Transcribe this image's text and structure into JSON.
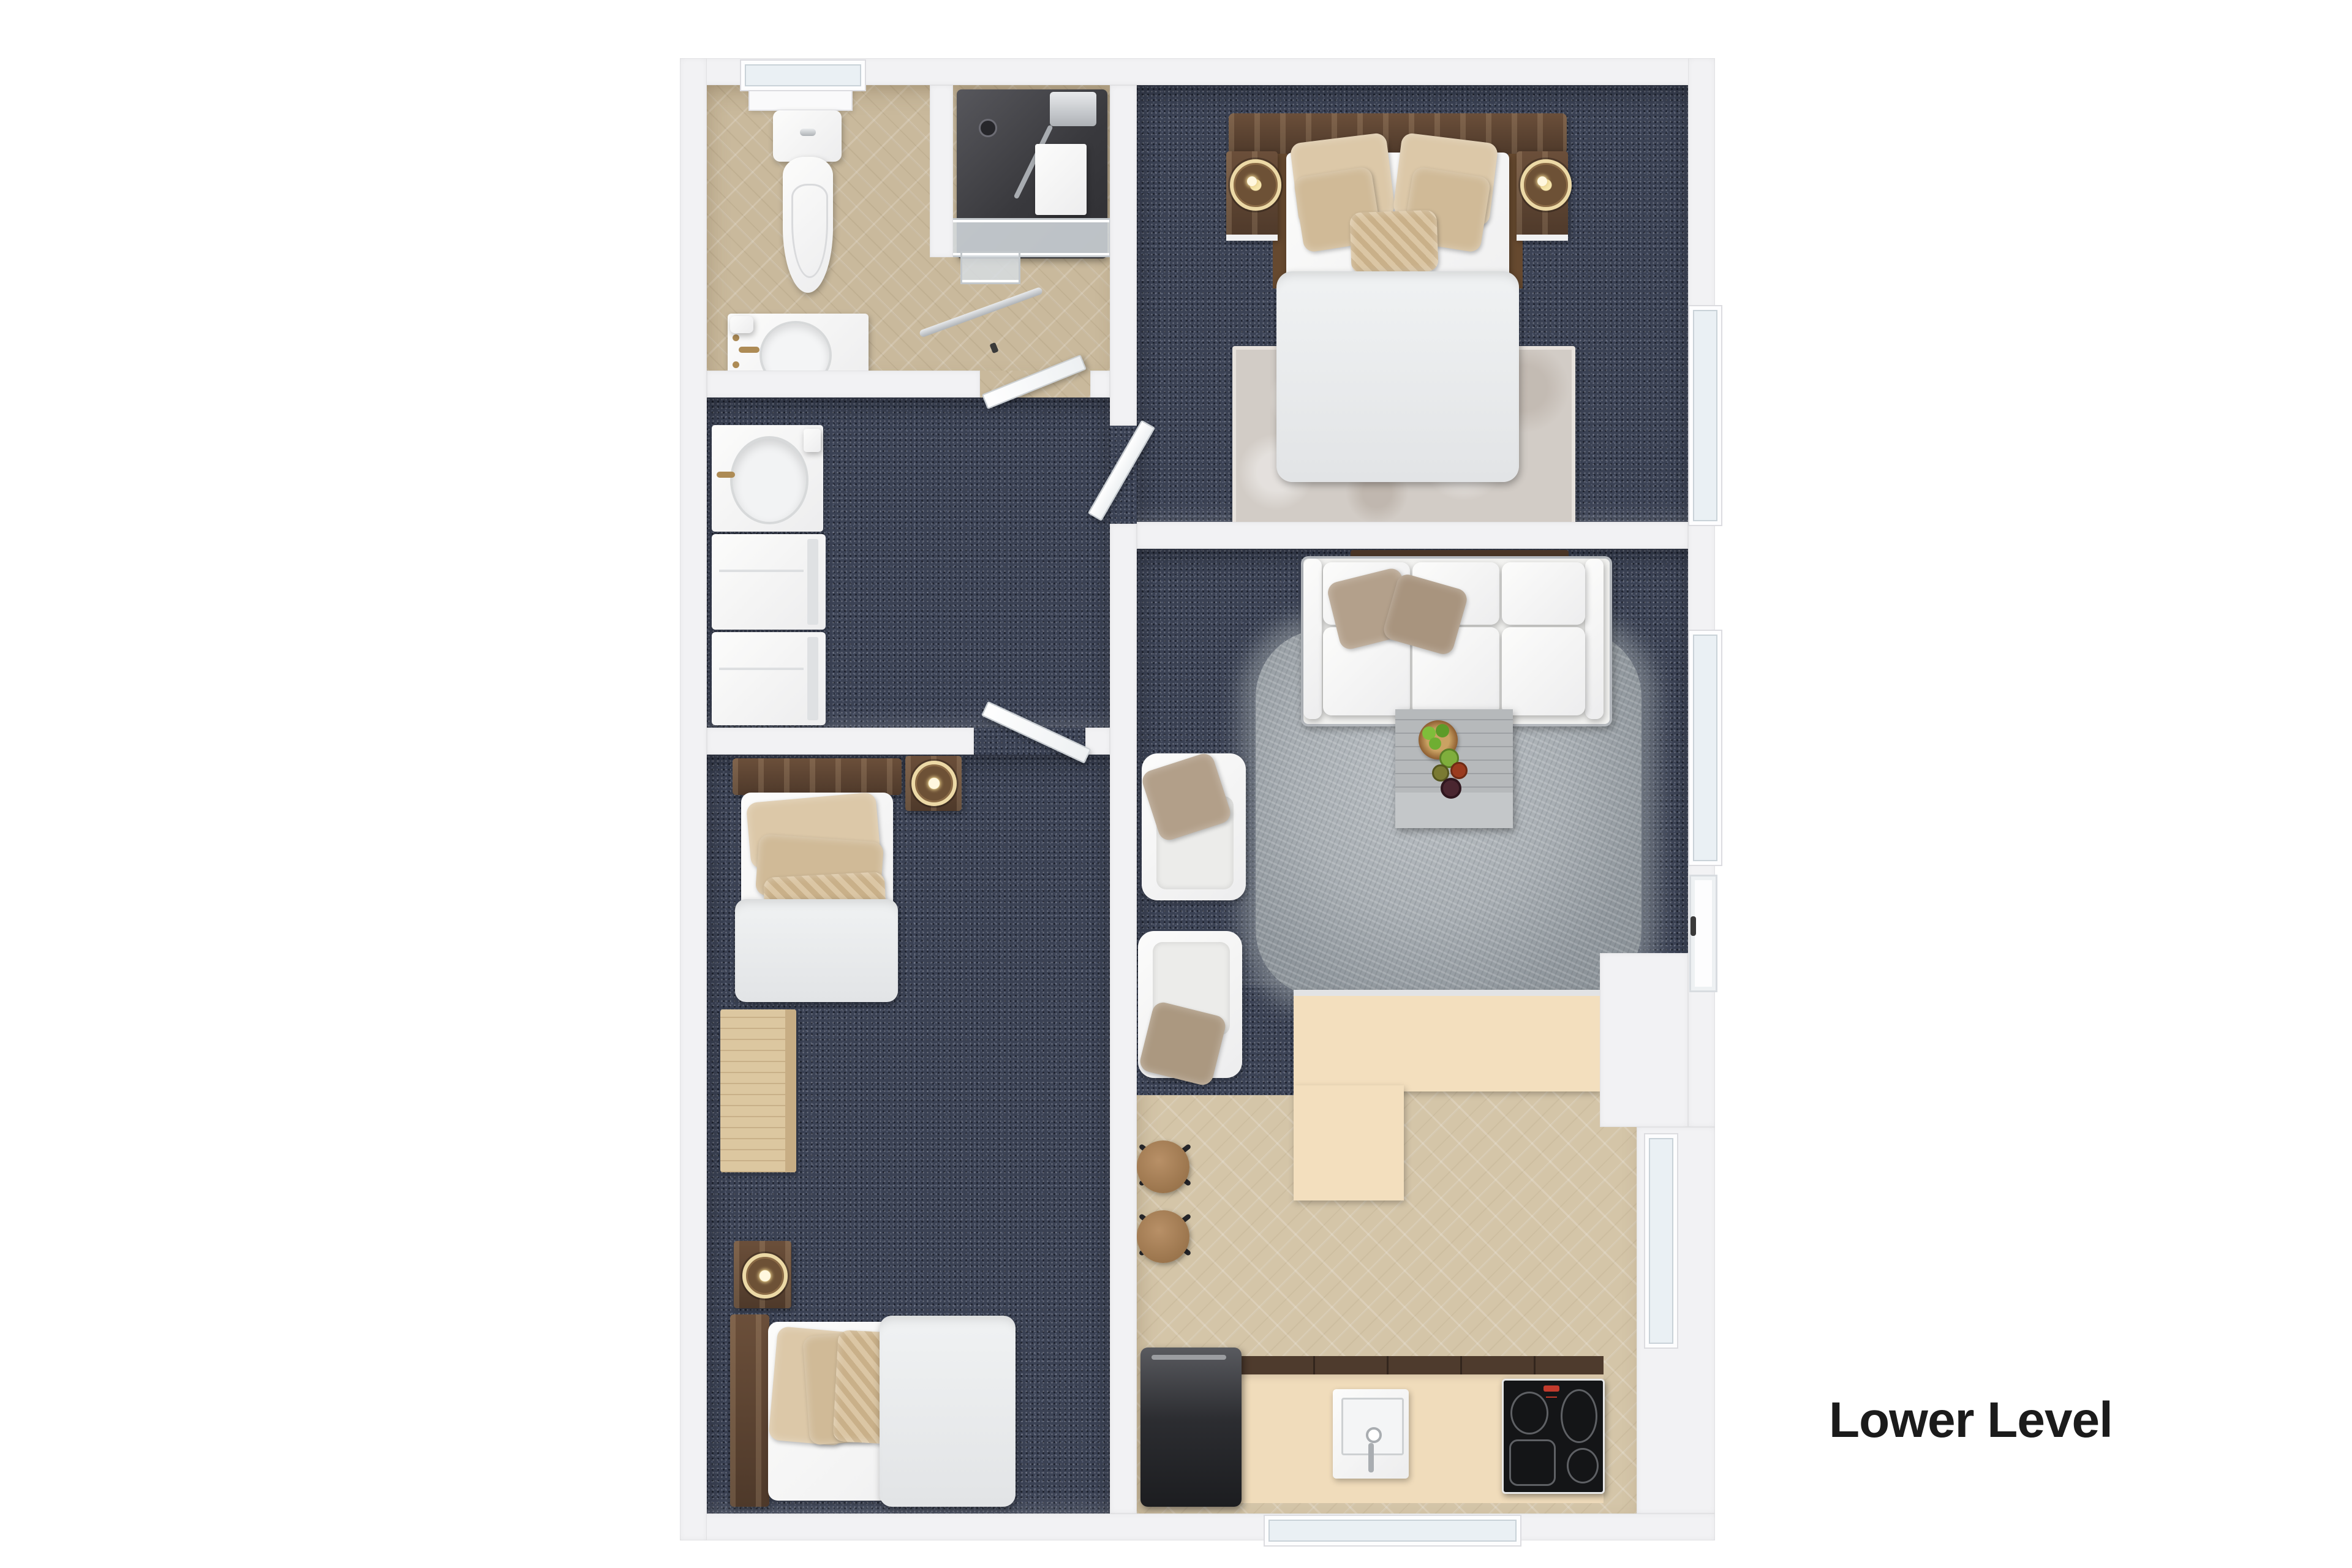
{
  "floor_plan": {
    "level_name": "Lower Level",
    "type": "3d-rendered top-down floor plan",
    "rooms": [
      {
        "name": "bathroom",
        "floor": "beige-tile",
        "furniture": [
          "toilet",
          "shower-enclosure",
          "vanity-sink",
          "window"
        ]
      },
      {
        "name": "laundry-room",
        "floor": "navy-carpet",
        "furniture": [
          "utility-sink",
          "washer",
          "dryer"
        ]
      },
      {
        "name": "bedroom",
        "floor": "navy-carpet",
        "furniture": [
          "twin-bed-1",
          "twin-bed-2",
          "nightstand-1",
          "nightstand-2",
          "table-lamp-1",
          "table-lamp-2",
          "dresser"
        ]
      },
      {
        "name": "primary-bedroom",
        "floor": "navy-carpet",
        "furniture": [
          "double-bed",
          "headboard",
          "nightstand-left",
          "nightstand-right",
          "table-lamp-left",
          "table-lamp-right",
          "area-rug",
          "window"
        ]
      },
      {
        "name": "living-room",
        "floor": "navy-carpet",
        "furniture": [
          "sofa",
          "console-shelf",
          "armchair-1",
          "armchair-2",
          "shag-rug",
          "coffee-table",
          "bowl-of-limes",
          "drink-cups",
          "window",
          "patio-door"
        ]
      },
      {
        "name": "kitchen",
        "floor": "beige-tile",
        "furniture": [
          "l-shaped-island-counter",
          "bar-stool-1",
          "bar-stool-2",
          "refrigerator",
          "kitchen-sink",
          "cooktop",
          "base-cabinets",
          "window-right",
          "window-bottom"
        ]
      }
    ],
    "doors": [
      "bathroom-door",
      "primary-bedroom-door",
      "bedroom-door"
    ],
    "colors": {
      "background": "#ffffff",
      "walls": "#f2f2f4",
      "carpet": "#3b4254",
      "tile_bath": "#c9b99c",
      "tile_kitchen": "#d4c5a8",
      "counter": "#f3dfbe",
      "wood_dark": "#5c4636",
      "wood_light": "#dcc7a0",
      "lamp_gold": "#ecd9a6",
      "shower_dark": "#3a3a3e",
      "title_text": "#1b1b1b"
    }
  }
}
